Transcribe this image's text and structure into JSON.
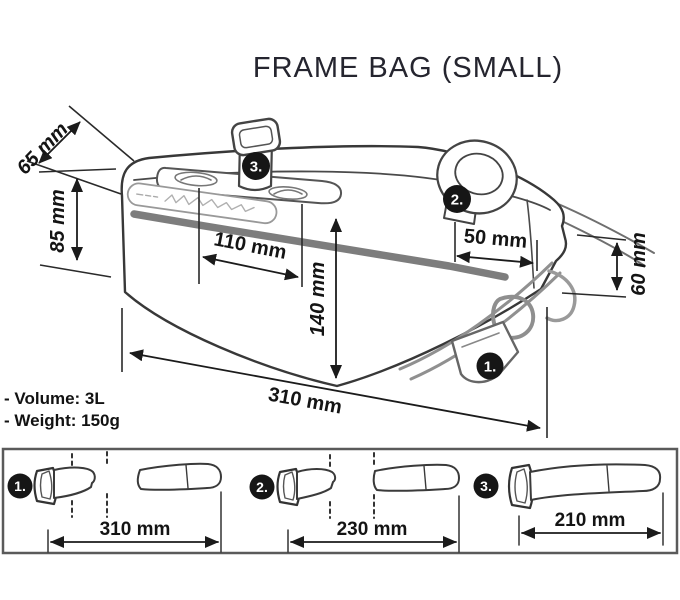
{
  "title": "FRAME BAG (SMALL)",
  "specs": {
    "volume": "- Volume: 3L",
    "weight": "- Weight: 150g"
  },
  "main_dimensions": {
    "top_width": "65 mm",
    "front_height": "85 mm",
    "strap_spacing": "110 mm",
    "center_height": "140 mm",
    "rear_offset": "50 mm",
    "rear_height": "60 mm",
    "length": "310 mm"
  },
  "markers": {
    "1": "1.",
    "2": "2.",
    "3": "3."
  },
  "straps": [
    {
      "marker": "1.",
      "length": "310 mm"
    },
    {
      "marker": "2.",
      "length": "230 mm"
    },
    {
      "marker": "3.",
      "length": "210 mm"
    }
  ],
  "colors": {
    "line": "#1b1b1b",
    "zipper_gray": "#7d7d7d",
    "marker_bg": "#161616",
    "legend_border": "#5a5a5a",
    "title_text": "#25252f"
  }
}
